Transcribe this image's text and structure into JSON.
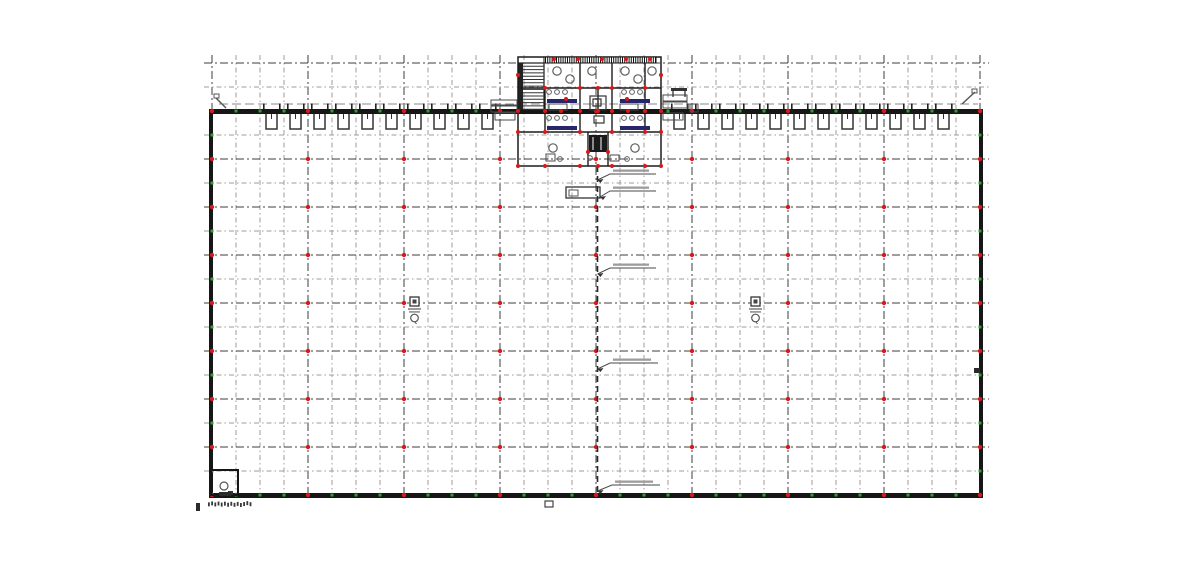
{
  "meta": {
    "drawing_type": "warehouse-floor-plan",
    "description": "CAD site plan: large rectangular warehouse with structural grid, dock doors along top wall, central office core, expansion joint line, sprinkler/column markers"
  },
  "colors": {
    "background": "#ffffff",
    "wall": "#161616",
    "grid_major": "#3c3c3c",
    "grid_minor": "#9e9e9e",
    "red_marker": "#dd1717",
    "green_marker": "#2f9e2f",
    "navy_fixture": "#26266a",
    "fixture_line": "#5f5f5f",
    "annotation_smudge": "#9c9c9c",
    "joint_line": "#262626",
    "core_wall": "#1c1c1c"
  },
  "canvas": {
    "width": 1200,
    "height": 569
  },
  "plan": {
    "grid": {
      "col_start": 212,
      "col_end": 980,
      "col_step": 24,
      "col_major_every": 96,
      "col_top": 55,
      "col_bottom": 493,
      "row_start": 63,
      "row_end": 471,
      "row_step": 24,
      "row_major_anchor": 159,
      "row_major_step": 48,
      "row_left": 204,
      "row_right": 989,
      "wall_top_y": 111,
      "wall_bottom_y": 495
    },
    "walls": {
      "top": {
        "x": 209,
        "y": 109,
        "w": 774,
        "h": 5
      },
      "bottom": {
        "x": 209,
        "y": 493,
        "w": 774,
        "h": 5
      },
      "left": {
        "x": 209,
        "y": 109,
        "w": 4,
        "h": 389
      },
      "right": {
        "x": 979,
        "y": 109,
        "w": 4,
        "h": 389
      }
    },
    "canopy": {
      "y": 104,
      "x1": 219,
      "x2": 978
    },
    "dock_doors": {
      "bay": 24,
      "door_y": 114,
      "door_h": 15,
      "inset": 6,
      "width": 11,
      "left_first_bay": 260,
      "left_count": 10,
      "right_first_bay": 668,
      "right_count": 12,
      "bumper_y1": 103.5,
      "bumper_y2": 109
    },
    "expansion_joint": {
      "x": 597.5,
      "y1": 166,
      "y2": 493
    },
    "leaders": [
      {
        "ax": 597.5,
        "ay": 180,
        "bx": 610,
        "by": 174,
        "len": 46
      },
      {
        "ax": 600,
        "ay": 197,
        "bx": 610,
        "by": 191,
        "len": 46
      },
      {
        "ax": 597.5,
        "ay": 274,
        "bx": 610,
        "by": 268,
        "len": 46
      },
      {
        "ax": 597.5,
        "ay": 369,
        "bx": 610,
        "by": 363,
        "len": 48
      },
      {
        "ax": 597.5,
        "ay": 491,
        "bx": 612,
        "by": 485,
        "len": 48
      }
    ],
    "joint_box": {
      "x": 566,
      "y": 187,
      "w": 34,
      "h": 11,
      "inner": {
        "x": 569,
        "y": 190,
        "w": 9,
        "h": 6
      }
    },
    "equipment_symbols": [
      {
        "x": 410,
        "y": 297
      },
      {
        "x": 751,
        "y": 297
      }
    ],
    "corner_room": {
      "x": 211,
      "y": 470,
      "w": 27,
      "h": 25,
      "circle": {
        "cx": 224,
        "cy": 486,
        "r": 4
      },
      "mark": {
        "x": 228,
        "y": 491,
        "w": 5,
        "h": 4
      }
    },
    "ramps": [
      {
        "x1": 216,
        "y1": 98,
        "x2": 226,
        "y2": 108,
        "rect": [
          214,
          94,
          5,
          4
        ]
      },
      {
        "x1": 962,
        "y1": 104,
        "x2": 975,
        "y2": 92,
        "rect": [
          972,
          89,
          5,
          4
        ]
      }
    ],
    "misc_marks": [
      {
        "type": "fill",
        "x": 219,
        "y": 492,
        "w": 12,
        "h": 4
      },
      {
        "type": "fill",
        "x": 974,
        "y": 368,
        "w": 6,
        "h": 5
      },
      {
        "type": "stroke",
        "x": 545,
        "y": 501,
        "w": 8,
        "h": 6
      },
      {
        "type": "smudgetext",
        "x": 208,
        "y": 501,
        "w": 44,
        "h": 6
      },
      {
        "type": "fill",
        "x": 196,
        "y": 503,
        "w": 4,
        "h": 8
      }
    ],
    "core": {
      "outline": {
        "x": 518,
        "y": 57,
        "w": 143,
        "h": 109
      },
      "hatch_band": {
        "x": 544,
        "y": 57,
        "w": 112,
        "h": 6,
        "pitch": 2.2
      },
      "stair": {
        "x": 519,
        "y": 63,
        "w": 25,
        "h": 47,
        "tread": 3.3,
        "bar_w": 4
      },
      "h_walls": [
        [
          518,
          88,
          143
        ],
        [
          518,
          132,
          143
        ]
      ],
      "v_walls": [
        [
          580,
          63,
          25
        ],
        [
          612,
          63,
          25
        ],
        [
          645,
          63,
          25
        ],
        [
          545,
          88,
          24
        ],
        [
          580,
          88,
          24
        ],
        [
          598,
          88,
          24
        ],
        [
          612,
          88,
          24
        ],
        [
          645,
          88,
          24
        ],
        [
          545,
          114,
          18
        ],
        [
          580,
          114,
          18
        ],
        [
          612,
          114,
          18
        ],
        [
          645,
          114,
          18
        ],
        [
          588,
          132,
          34
        ],
        [
          608,
          132,
          34
        ]
      ],
      "navy_bars": [
        [
          547,
          99,
          30,
          4
        ],
        [
          620,
          99,
          30,
          4
        ],
        [
          547,
          126,
          30,
          4
        ],
        [
          620,
          126,
          30,
          4
        ]
      ],
      "shaft": {
        "x": 589,
        "y": 135,
        "w": 18,
        "h": 17
      },
      "boxes": [
        [
          590,
          96,
          16,
          14
        ],
        [
          593,
          99,
          8,
          7
        ],
        [
          594,
          116,
          10,
          7
        ]
      ],
      "circles_lg": [
        [
          557,
          71
        ],
        [
          570,
          79
        ],
        [
          592,
          71
        ],
        [
          625,
          71
        ],
        [
          638,
          79
        ],
        [
          652,
          71
        ],
        [
          553,
          148
        ],
        [
          635,
          148
        ]
      ],
      "circles_sm": [
        [
          549,
          92
        ],
        [
          557,
          92
        ],
        [
          565,
          92
        ],
        [
          624,
          92
        ],
        [
          632,
          92
        ],
        [
          640,
          92
        ],
        [
          549,
          118
        ],
        [
          557,
          118
        ],
        [
          565,
          118
        ],
        [
          624,
          118
        ],
        [
          632,
          118
        ],
        [
          640,
          118
        ],
        [
          560,
          159
        ],
        [
          590,
          158
        ],
        [
          627,
          159
        ]
      ],
      "fixtures": [
        [
          549,
          104,
          18,
          6
        ],
        [
          620,
          104,
          18,
          6
        ],
        [
          546,
          154,
          9,
          7
        ],
        [
          610,
          155,
          9,
          6
        ],
        [
          663,
          95,
          24,
          6
        ],
        [
          663,
          102,
          24,
          6
        ],
        [
          491,
          100,
          26,
          5
        ],
        [
          491,
          106,
          26,
          6
        ],
        [
          663,
          113,
          20,
          7
        ],
        [
          495,
          113,
          20,
          7
        ],
        [
          690,
          104,
          8,
          8
        ]
      ],
      "table": {
        "x": 671,
        "y": 88,
        "w": 16,
        "h": 3,
        "legs": [
          [
            673,
            91,
            673,
            97
          ],
          [
            685,
            91,
            685,
            97
          ]
        ]
      },
      "red_dots": [
        [
          545,
          88
        ],
        [
          580,
          88
        ],
        [
          598,
          88
        ],
        [
          612,
          88
        ],
        [
          645,
          88
        ],
        [
          518,
          111
        ],
        [
          545,
          111
        ],
        [
          561,
          111
        ],
        [
          580,
          111
        ],
        [
          598,
          111
        ],
        [
          612,
          111
        ],
        [
          628,
          111
        ],
        [
          645,
          111
        ],
        [
          661,
          111
        ],
        [
          518,
          132
        ],
        [
          545,
          132
        ],
        [
          580,
          132
        ],
        [
          612,
          132
        ],
        [
          645,
          132
        ],
        [
          661,
          132
        ],
        [
          518,
          166
        ],
        [
          545,
          166
        ],
        [
          580,
          166
        ],
        [
          598,
          166
        ],
        [
          612,
          166
        ],
        [
          645,
          166
        ],
        [
          661,
          166
        ],
        [
          554,
          59
        ],
        [
          578,
          59
        ],
        [
          602,
          59
        ],
        [
          626,
          59
        ],
        [
          650,
          59
        ],
        [
          518,
          75
        ],
        [
          661,
          75
        ],
        [
          588,
          152
        ],
        [
          608,
          152
        ],
        [
          566,
          99
        ],
        [
          627,
          99
        ]
      ]
    }
  }
}
